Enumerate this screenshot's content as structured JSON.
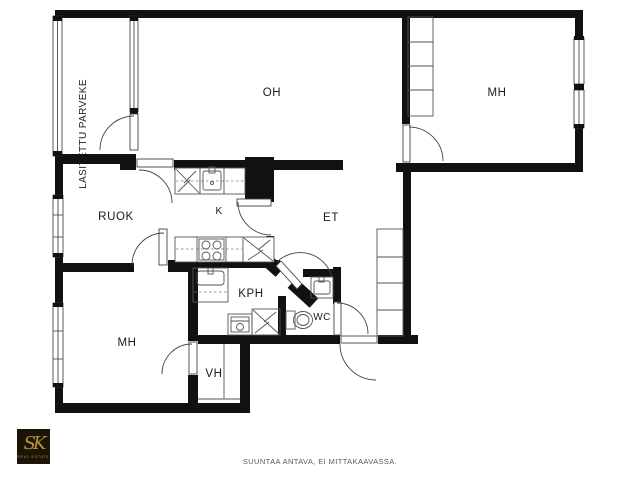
{
  "floor_plan": {
    "rooms": [
      {
        "id": "balcony",
        "label": "LASITETTU PARVEKE"
      },
      {
        "id": "living",
        "label": "OH"
      },
      {
        "id": "bedroom1",
        "label": "MH"
      },
      {
        "id": "dining",
        "label": "RUOK"
      },
      {
        "id": "kitchen",
        "label": "K"
      },
      {
        "id": "hall",
        "label": "ET"
      },
      {
        "id": "bathroom",
        "label": "KPH"
      },
      {
        "id": "wc",
        "label": "WC"
      },
      {
        "id": "bedroom2",
        "label": "MH"
      },
      {
        "id": "closet",
        "label": "VH"
      }
    ]
  },
  "branding": {
    "logo_text": "SK",
    "logo_subtext": "REAL ESTATE",
    "logo_bg": "#1d1408",
    "logo_gold": "#b5913d"
  },
  "footer": {
    "disclaimer": "SUUNTAA ANTAVA, EI MITTAKAAVASSA."
  },
  "colors": {
    "wall": "#111111",
    "background": "#ffffff",
    "fixture_line": "#555555",
    "label": "#1a1a1a"
  }
}
